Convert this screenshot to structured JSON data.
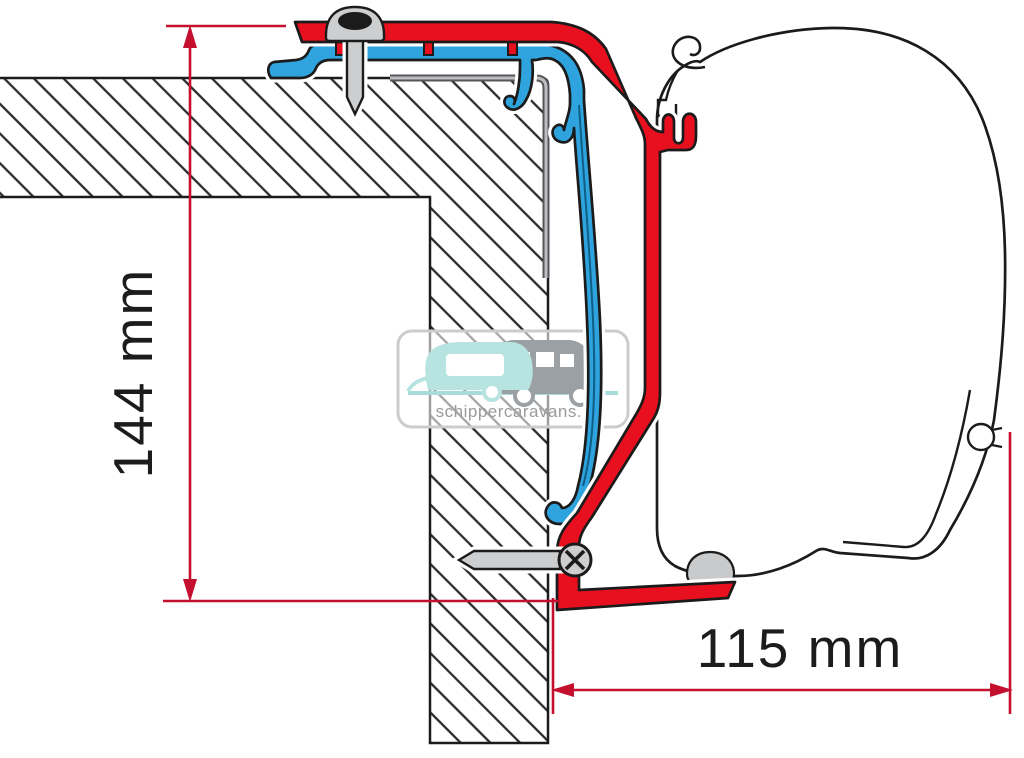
{
  "diagram": {
    "title": "Awning adapter bracket cross-section",
    "dimensions": [
      {
        "label": "144 mm",
        "orientation": "vertical"
      },
      {
        "label": "115 mm",
        "orientation": "horizontal"
      }
    ],
    "watermark": {
      "text": "schippercaravans.nl"
    },
    "colors": {
      "bracket_red": "#e8101e",
      "adapter_blue": "#2ea3dd",
      "dimension_red": "#c50f2e",
      "outline_black": "#1b1b1b",
      "trim_gray": "#55565a",
      "trim_gray_light": "#bdbec0",
      "screw_gray": "#cdcecf",
      "watermark_teal": "#b7e3e0",
      "watermark_gray": "#9aa0a4",
      "watermark_text_gray": "#9b9b9b"
    },
    "parts": [
      "vehicle-wall-cross-section",
      "roof-edge-trim",
      "blue-adapter-profile",
      "red-awning-bracket",
      "top-roof-screw",
      "side-wall-screw",
      "awning-case-profile"
    ]
  }
}
